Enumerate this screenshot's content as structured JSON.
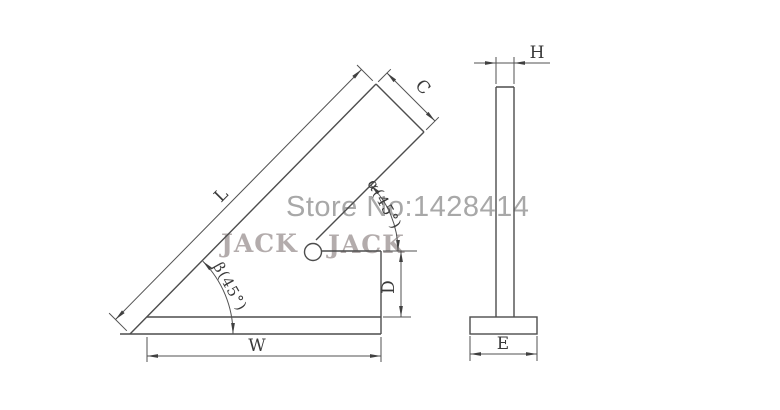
{
  "front_view": {
    "title": "45-degree square front view",
    "labels": {
      "blade_length": "L",
      "blade_width": "C",
      "alpha_angle": "α(45°)",
      "beta_angle": "β(45°)",
      "base_width": "W",
      "step_height": "D"
    }
  },
  "side_view": {
    "title": "side profile view",
    "labels": {
      "blade_thickness": "H",
      "base_depth": "E"
    }
  },
  "watermarks": {
    "store_number": "Store No:1428414",
    "brand_left": "JACK",
    "brand_right": "JACK"
  },
  "colors": {
    "line": "#4d4d4d",
    "label_text": "#3a3a3a",
    "store_watermark": "#a8a8a8",
    "brand_watermark": "#b3acac",
    "background": "#ffffff"
  }
}
